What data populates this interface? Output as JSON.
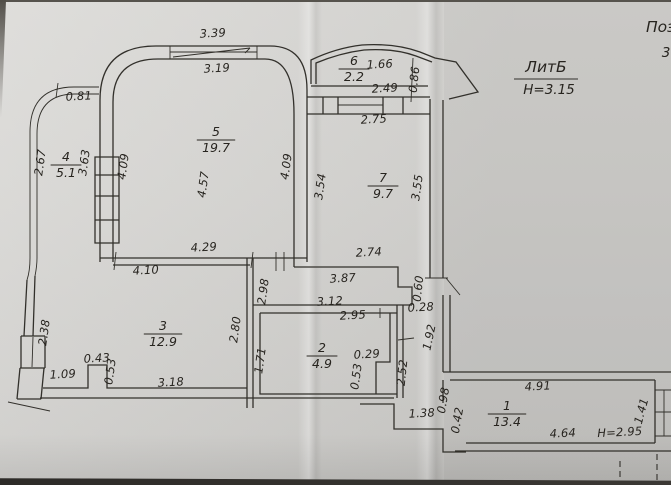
{
  "annotations": {
    "liter": "ЛитБ",
    "floor_height": "Н=3.15",
    "corner_text": "Поэт",
    "corner_number": "3"
  },
  "rooms": [
    {
      "number": "1",
      "area": "13.4",
      "x": 507,
      "y": 410
    },
    {
      "number": "2",
      "area": "4.9",
      "x": 322,
      "y": 352
    },
    {
      "number": "3",
      "area": "12.9",
      "x": 163,
      "y": 330
    },
    {
      "number": "4",
      "area": "5.1",
      "x": 66,
      "y": 161
    },
    {
      "number": "5",
      "area": "19.7",
      "x": 216,
      "y": 136
    },
    {
      "number": "6",
      "area": "2.2",
      "x": 354,
      "y": 65
    },
    {
      "number": "7",
      "area": "9.7",
      "x": 383,
      "y": 182
    }
  ],
  "dimensions": [
    {
      "v": "3.39",
      "x": 213,
      "y": 37
    },
    {
      "v": "3.19",
      "x": 217,
      "y": 72
    },
    {
      "v": "0.81",
      "x": 79,
      "y": 100
    },
    {
      "v": "2.67",
      "x": 44,
      "y": 163,
      "r": -82
    },
    {
      "v": "3.63",
      "x": 88,
      "y": 163,
      "r": -82
    },
    {
      "v": "4.09",
      "x": 127,
      "y": 167,
      "r": -82
    },
    {
      "v": "4.57",
      "x": 207,
      "y": 185,
      "r": -82
    },
    {
      "v": "4.09",
      "x": 290,
      "y": 167,
      "r": -82
    },
    {
      "v": "3.54",
      "x": 324,
      "y": 187,
      "r": -82
    },
    {
      "v": "3.55",
      "x": 421,
      "y": 188,
      "r": -82
    },
    {
      "v": "1.66",
      "x": 380,
      "y": 68
    },
    {
      "v": "2.49",
      "x": 385,
      "y": 92
    },
    {
      "v": "0.86",
      "x": 418,
      "y": 80,
      "r": -84
    },
    {
      "v": "2.75",
      "x": 374,
      "y": 123
    },
    {
      "v": "2.74",
      "x": 369,
      "y": 256
    },
    {
      "v": "4.29",
      "x": 204,
      "y": 251
    },
    {
      "v": "4.10",
      "x": 146,
      "y": 274
    },
    {
      "v": "3.87",
      "x": 343,
      "y": 282
    },
    {
      "v": "2.98",
      "x": 267,
      "y": 292,
      "r": -82
    },
    {
      "v": "3.12",
      "x": 330,
      "y": 305
    },
    {
      "v": "0.60",
      "x": 422,
      "y": 289,
      "r": -84
    },
    {
      "v": "0.28",
      "x": 421,
      "y": 311
    },
    {
      "v": "2.38",
      "x": 48,
      "y": 333,
      "r": -82
    },
    {
      "v": "2.80",
      "x": 239,
      "y": 330,
      "r": -82
    },
    {
      "v": "2.95",
      "x": 353,
      "y": 319
    },
    {
      "v": "1.71",
      "x": 264,
      "y": 361,
      "r": -82
    },
    {
      "v": "0.29",
      "x": 367,
      "y": 358
    },
    {
      "v": "0.53",
      "x": 360,
      "y": 377,
      "r": -82
    },
    {
      "v": "2.52",
      "x": 406,
      "y": 373,
      "r": -84
    },
    {
      "v": "1.92",
      "x": 433,
      "y": 338,
      "r": -78
    },
    {
      "v": "0.43",
      "x": 97,
      "y": 362
    },
    {
      "v": "0.53",
      "x": 114,
      "y": 372,
      "r": -82
    },
    {
      "v": "1.09",
      "x": 63,
      "y": 378
    },
    {
      "v": "3.18",
      "x": 171,
      "y": 386
    },
    {
      "v": "1.38",
      "x": 422,
      "y": 417
    },
    {
      "v": "0.98",
      "x": 447,
      "y": 401,
      "r": -80
    },
    {
      "v": "0.42",
      "x": 461,
      "y": 421,
      "r": -80
    },
    {
      "v": "4.91",
      "x": 538,
      "y": 390
    },
    {
      "v": "4.64",
      "x": 563,
      "y": 437
    },
    {
      "v": "Н=2.95",
      "x": 620,
      "y": 436
    },
    {
      "v": "1.41",
      "x": 645,
      "y": 412,
      "r": -75
    }
  ]
}
